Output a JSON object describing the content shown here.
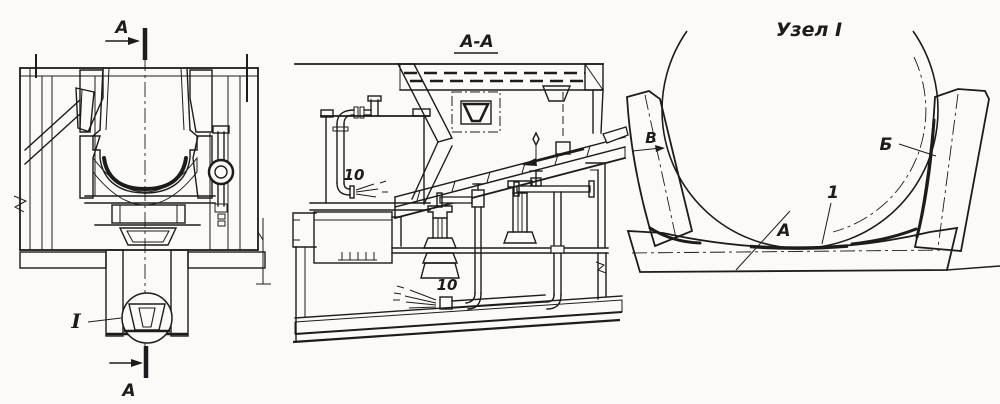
{
  "figure": {
    "background": "#fbfaf7",
    "ink": "#1c1c1c",
    "left_view": {
      "section_arrow_top_label": "А",
      "section_arrow_bottom_label": "А",
      "detail_callout_label": "I"
    },
    "section_view": {
      "title": "А-А",
      "spray_pipe_label_upper": "10",
      "spray_pipe_label_lower": "10"
    },
    "detail_view": {
      "title": "Узел I",
      "gap_label": "В",
      "liner_label": "Б",
      "bed_label": "А",
      "shell_label": "1"
    }
  }
}
